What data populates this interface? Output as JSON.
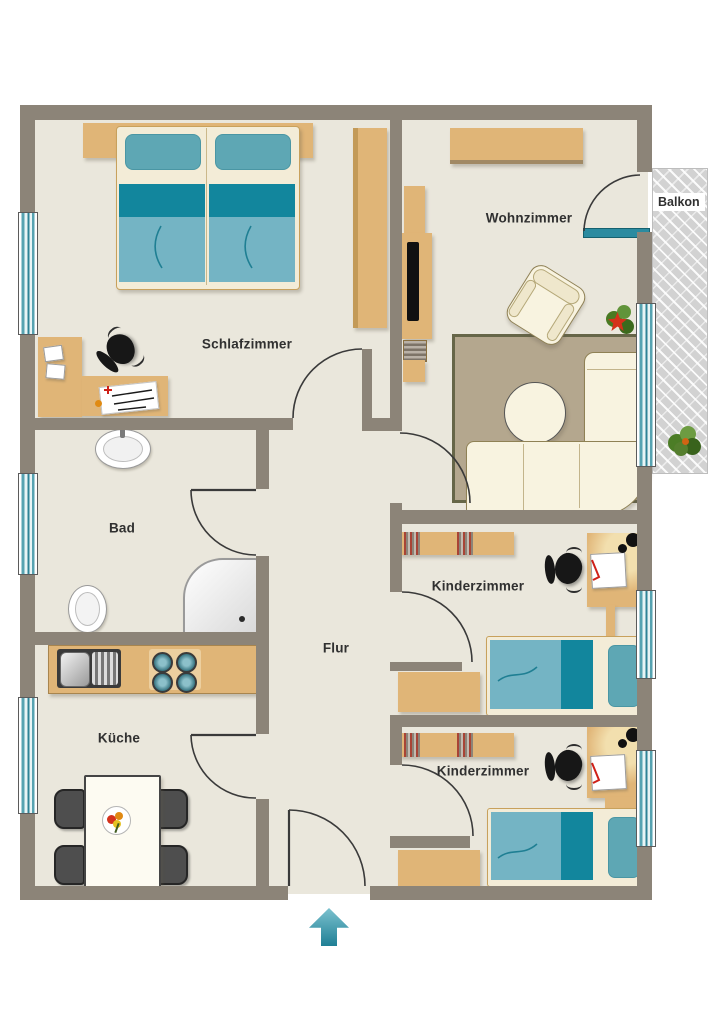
{
  "plan": {
    "title": "apartment-floor-plan",
    "rooms": {
      "schlafzimmer": {
        "label": "Schlafzimmer"
      },
      "wohnzimmer": {
        "label": "Wohnzimmer"
      },
      "balkon": {
        "label": "Balkon"
      },
      "bad": {
        "label": "Bad"
      },
      "flur": {
        "label": "Flur"
      },
      "kueche": {
        "label": "Küche"
      },
      "kinderzimmer_1": {
        "label": "Kinderzimmer"
      },
      "kinderzimmer_2": {
        "label": "Kinderzimmer"
      }
    },
    "colors": {
      "wall": "#8c8478",
      "floor": "#eae7dc",
      "wood": "#e0b577",
      "bedding_dark": "#12869d",
      "bedding_light": "#74b4c4",
      "pillow": "#5ea7b4",
      "window_glass": "#57a3b1",
      "balcony_floor": "#d2d2d2",
      "entrance_arrow": "#2a8ba0"
    },
    "icons": {
      "entrance_arrow": "up-arrow-entrance-marker"
    }
  }
}
